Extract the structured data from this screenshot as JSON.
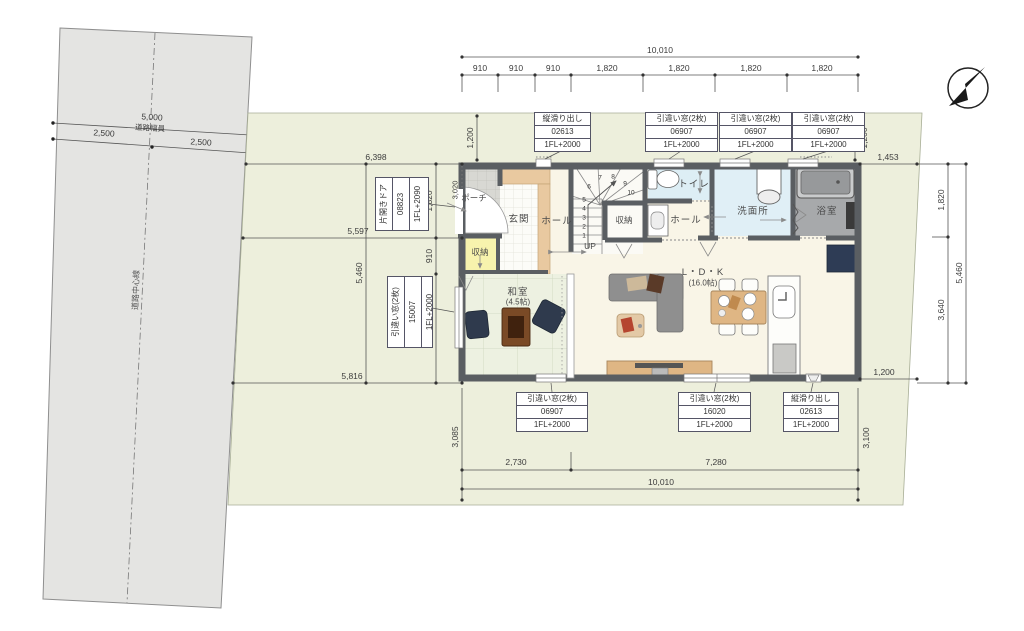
{
  "road": {
    "total_width": "5,000",
    "caption": "道路幅員",
    "half_left": "2,500",
    "half_right": "2,500",
    "centerline": "道路中心線"
  },
  "dims": {
    "top_total": "10,010",
    "top_segs": [
      "910",
      "910",
      "910",
      "1,820",
      "1,820",
      "1,820",
      "1,820"
    ],
    "top_offset_left": "1,200",
    "top_offset_right": "1,200",
    "left_6398": "6,398",
    "left_1820": "1,820",
    "left_5597": "5,597",
    "left_910": "910",
    "left_5460": "5,460",
    "left_2730": "2,730",
    "left_5816": "5,816",
    "left_3020": "3,020",
    "right_1453": "1,453",
    "right_1820": "1,820",
    "right_3640": "3,640",
    "right_5460": "5,460",
    "right_1200": "1,200",
    "bottom_3085": "3,085",
    "bottom_2730": "2,730",
    "bottom_7280": "7,280",
    "bottom_total": "10,010",
    "bottom_3100": "3,100"
  },
  "openings": {
    "top": [
      {
        "type": "縦滑り出し",
        "code": "02613",
        "level": "1FL+2000"
      },
      {
        "type": "引違い窓(2枚)",
        "code": "06907",
        "level": "1FL+2000"
      },
      {
        "type": "引違い窓(2枚)",
        "code": "06907",
        "level": "1FL+2000"
      },
      {
        "type": "引違い窓(2枚)",
        "code": "06907",
        "level": "1FL+2000"
      }
    ],
    "left": [
      {
        "type": "片開きドア",
        "code": "08823",
        "level": "1FL+2090"
      },
      {
        "type": "引違い窓(2枚)",
        "code": "15007",
        "level": "1FL+2000"
      }
    ],
    "bottom": [
      {
        "type": "引違い窓(2枚)",
        "code": "06907",
        "level": "1FL+2000"
      },
      {
        "type": "引違い窓(2枚)",
        "code": "16020",
        "level": "1FL+2000"
      },
      {
        "type": "縦滑り出し",
        "code": "02613",
        "level": "1FL+2000"
      }
    ]
  },
  "rooms": {
    "porch": "ポーチ",
    "entrance": "玄関",
    "hall_entrance": "ホール",
    "hall_back": "ホール",
    "closet_stairs": "収納",
    "closet_entrance": "収納",
    "toilet": "トイレ",
    "washroom": "洗面所",
    "bathroom": "浴室",
    "japanese_room": "和室",
    "japanese_room_size": "(4.5帖)",
    "ldk": "L・D・K",
    "ldk_size": "(16.0帖)",
    "up": "UP"
  },
  "stairs": {
    "numbers": [
      "1",
      "2",
      "3",
      "4",
      "5",
      "6",
      "7",
      "8",
      "9",
      "10"
    ]
  },
  "colors": {
    "site": "#edefdc",
    "road": "#e4e4e2",
    "wall": "#5a5e62",
    "tatami": "#edf1e1",
    "water_area": "#ddeef5",
    "closet": "#f7f3ad",
    "wood": "#e9c9a0",
    "floor": "#f9f5e7",
    "bath": "#a7a9ab",
    "fridge": "#2e3c55"
  }
}
